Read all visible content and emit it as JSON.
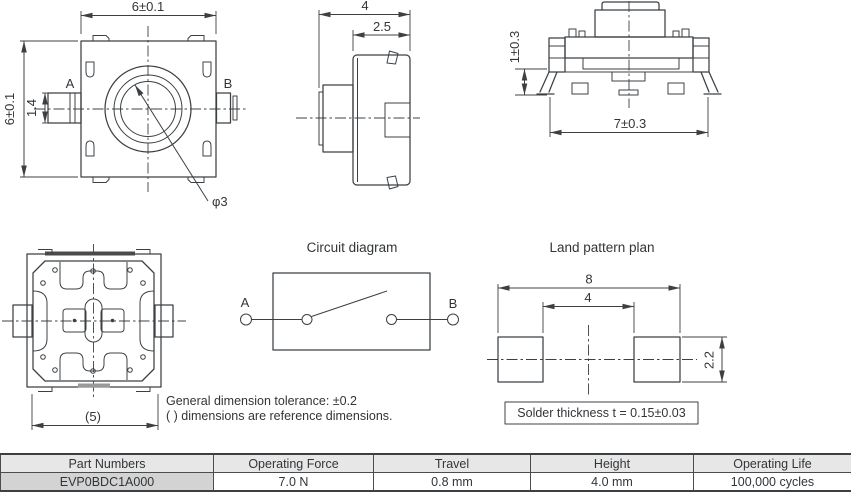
{
  "views": {
    "top": {
      "dim_width": "6±0.1",
      "dim_height": "6±0.1",
      "dim_terminal": "1.4",
      "label_a": "A",
      "label_b": "B",
      "dim_button": "φ3"
    },
    "side": {
      "dim_depth": "4",
      "dim_body": "2.5"
    },
    "front": {
      "dim_leg": "1±0.3",
      "dim_span": "7±0.3"
    },
    "bottom": {
      "dim_ref": "(5)"
    }
  },
  "circuit": {
    "title": "Circuit diagram",
    "label_a": "A",
    "label_b": "B"
  },
  "land_pattern": {
    "title": "Land pattern plan",
    "dim_outer": "8",
    "dim_inner": "4",
    "dim_pad": "2.2",
    "solder_note": "Solder thickness t = 0.15±0.03"
  },
  "notes": {
    "line1": "General dimension tolerance: ±0.2",
    "line2": "( ) dimensions are reference dimensions."
  },
  "spec_table": {
    "headers": [
      "Part Numbers",
      "Operating Force",
      "Travel",
      "Height",
      "Operating Life"
    ],
    "row": [
      "EVP0BDC1A000",
      "7.0 N",
      "0.8 mm",
      "4.0 mm",
      "100,000 cycles"
    ]
  },
  "colors": {
    "line": "#3c4043",
    "text": "#323538",
    "table_border": "#4a4d50",
    "table_header_bg": "#e7e7e7",
    "part_cell_bg": "#d3d3d3"
  }
}
